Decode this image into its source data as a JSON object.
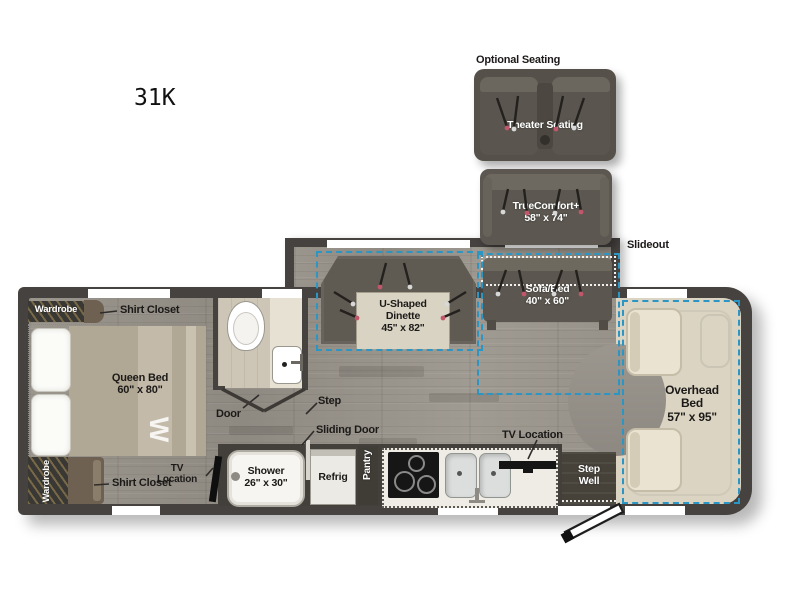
{
  "title": "31K",
  "optional": {
    "heading": "Optional Seating",
    "theater_label": "Theater Seating",
    "truecomfort_label": "TrueComfort+\n58\" x 74\""
  },
  "slideout_label": "Slideout",
  "labels": {
    "wardrobe_top": "Wardrobe",
    "shirt_closet_top": "Shirt Closet",
    "queen_bed": "Queen Bed\n60\" x 80\"",
    "monogram": "W",
    "wardrobe_bottom": "Wardrobe",
    "shirt_closet_bottom": "Shirt Closet",
    "door": "Door",
    "step": "Step",
    "sliding_door": "Sliding Door",
    "tv_location_bedroom": "TV\nLocation",
    "shower": "Shower\n26\" x 30\"",
    "refrig": "Refrig",
    "pantry": "Pantry",
    "dinette": "U-Shaped\nDinette\n45\" x 82\"",
    "sofa_bed": "Sofa/Bed\n40\" x 60\"",
    "tv_location_kitchen": "TV Location",
    "step_well": "Step\nWell",
    "overhead_bed": "Overhead\nBed\n57\" x 95\""
  },
  "colors": {
    "slide_accent": "#2b95c4",
    "wall": "#454240",
    "floor_gray": "#98938a",
    "floor_light": "#cdc6b6",
    "cab_beige": "#dbd4c3",
    "furniture_dark": "#5b564f"
  }
}
